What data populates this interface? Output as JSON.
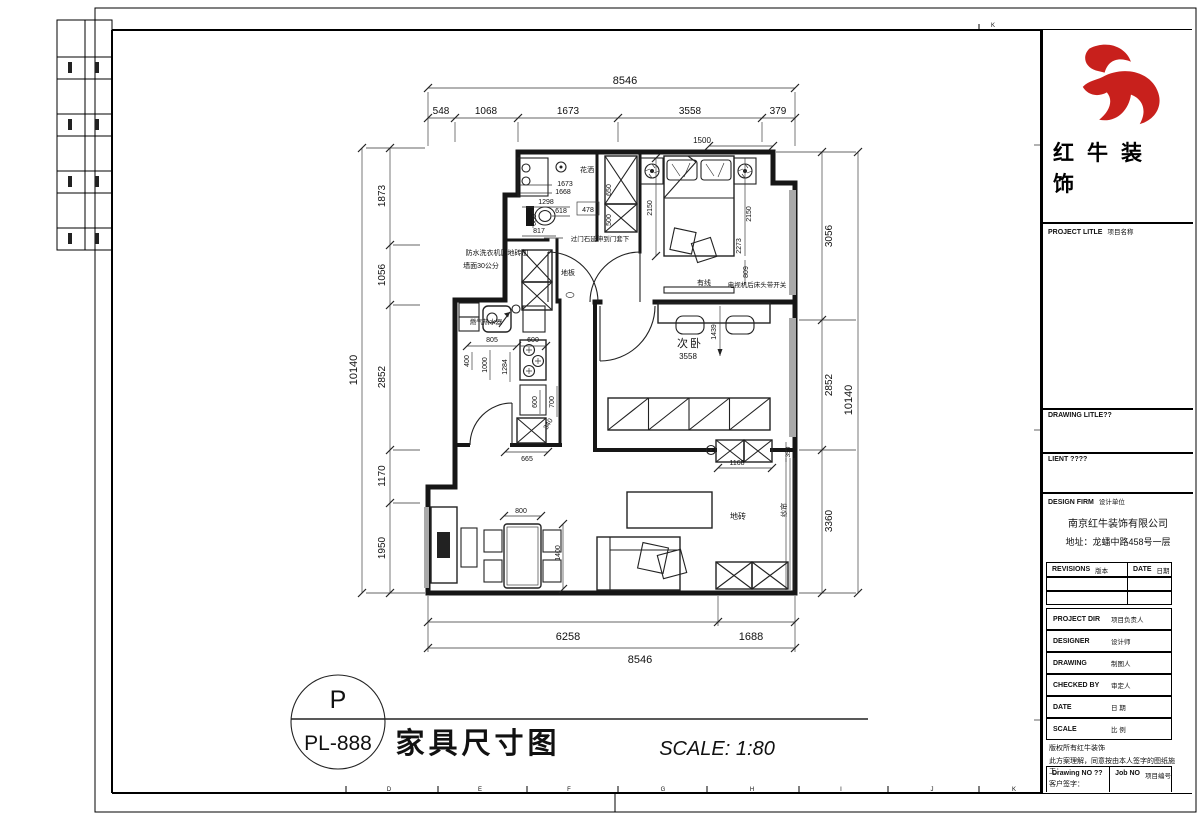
{
  "sheet": {
    "bottom_ruler_letters": [
      "D",
      "E",
      "F",
      "G",
      "H",
      "I",
      "J",
      "K"
    ],
    "top_right_letter": "K"
  },
  "footer": {
    "tag_top": "P",
    "tag_bottom": "PL-888",
    "drawing_title": "家具尺寸图",
    "scale_text": "SCALE: 1:80"
  },
  "title_block": {
    "brand_color": "#c8201c",
    "logo_icon": "bull-swoosh-icon",
    "brand_line1": "红牛装",
    "brand_line2": "饰",
    "project_title_label": {
      "en": "PROJECT LITLE",
      "zh": "项目名称"
    },
    "drawing_title_label": {
      "en": "DRAWING LITLE??",
      "zh": ""
    },
    "client_label": {
      "en": "LIENT ????",
      "zh": ""
    },
    "design_firm_label": {
      "en": "DESIGN FIRM",
      "zh": "设计单位"
    },
    "company_name": "南京红牛装饰有限公司",
    "company_address": "地址：龙蟠中路458号一层",
    "revisions_label": {
      "en": "REVISIONS",
      "zh": "版本"
    },
    "date_col_label": {
      "en": "DATE",
      "zh": "日期"
    },
    "rows": {
      "project_dir": {
        "en": "PROJECT DIR",
        "zh": "项目负责人"
      },
      "designer": {
        "en": "DESIGNER",
        "zh": "设计师"
      },
      "drawing": {
        "en": "DRAWING",
        "zh": "制图人"
      },
      "checked_by": {
        "en": "CHECKED BY",
        "zh": "审定人"
      },
      "date": {
        "en": "DATE",
        "zh": "日 期"
      },
      "scale": {
        "en": "SCALE",
        "zh": "比 例"
      }
    },
    "signature_lines": [
      "版权所有红牛装饰",
      "此方案理解，同意按由本人签字的图纸施工：",
      "客户签字："
    ],
    "drawing_no_label": {
      "en": "Drawing NO ??",
      "zh": ""
    },
    "job_no_label": {
      "en": "Job NO",
      "zh": "项目编号"
    }
  },
  "plan": {
    "dims": {
      "top_total": "8546",
      "top_segments": [
        "548",
        "1068",
        "1673",
        "3558",
        "379"
      ],
      "top_inner": "1500",
      "left_total": "10140",
      "left_segments": [
        "1873",
        "1056",
        "2852",
        "1170",
        "1950"
      ],
      "right_segments": [
        "3056",
        "2852",
        "3360"
      ],
      "right_total": "10140",
      "bottom_segments": [
        "6258",
        "1688"
      ],
      "bottom_total": "8546"
    },
    "bathroom": {
      "dim_1673": "1673",
      "dim_1668": "1668",
      "dim_1298": "1298",
      "dim_618": "618",
      "dim_478": "478",
      "dim_680": "680",
      "dim_817": "817",
      "shower_label": "花洒",
      "door_stone_note": "过门石延伸到门套下",
      "laundry_note_line1": "防水洗衣机区地砖加",
      "laundry_note_line2": "墙面30公分"
    },
    "hall": {
      "closet_dim_650": "650",
      "closet_dim_500": "500",
      "floor_label": "地板"
    },
    "master_bedroom": {
      "dim_left_2150": "2150",
      "dim_right_2150": "2150",
      "dim_2273": "2273",
      "dim_809": "809",
      "cable_label": "有线",
      "tv_note": "电视机后床头带开关"
    },
    "second_bedroom": {
      "name": "次卧",
      "dim_3558": "3558",
      "dim_1439": "1439",
      "dim_1168": "1168",
      "dim_350": "350"
    },
    "kitchen": {
      "heater_label": "燃气热水器",
      "dim_805": "805",
      "dim_600_top": "600",
      "dim_400": "400",
      "dim_1000": "1000",
      "dim_1284": "1284",
      "dim_600_bottom": "600",
      "dim_700": "700",
      "dim_340": "340",
      "dim_665": "665"
    },
    "living": {
      "dim_800": "800",
      "dim_1400": "1400",
      "tile_label": "地砖",
      "curtain_label": "纱帘"
    }
  }
}
